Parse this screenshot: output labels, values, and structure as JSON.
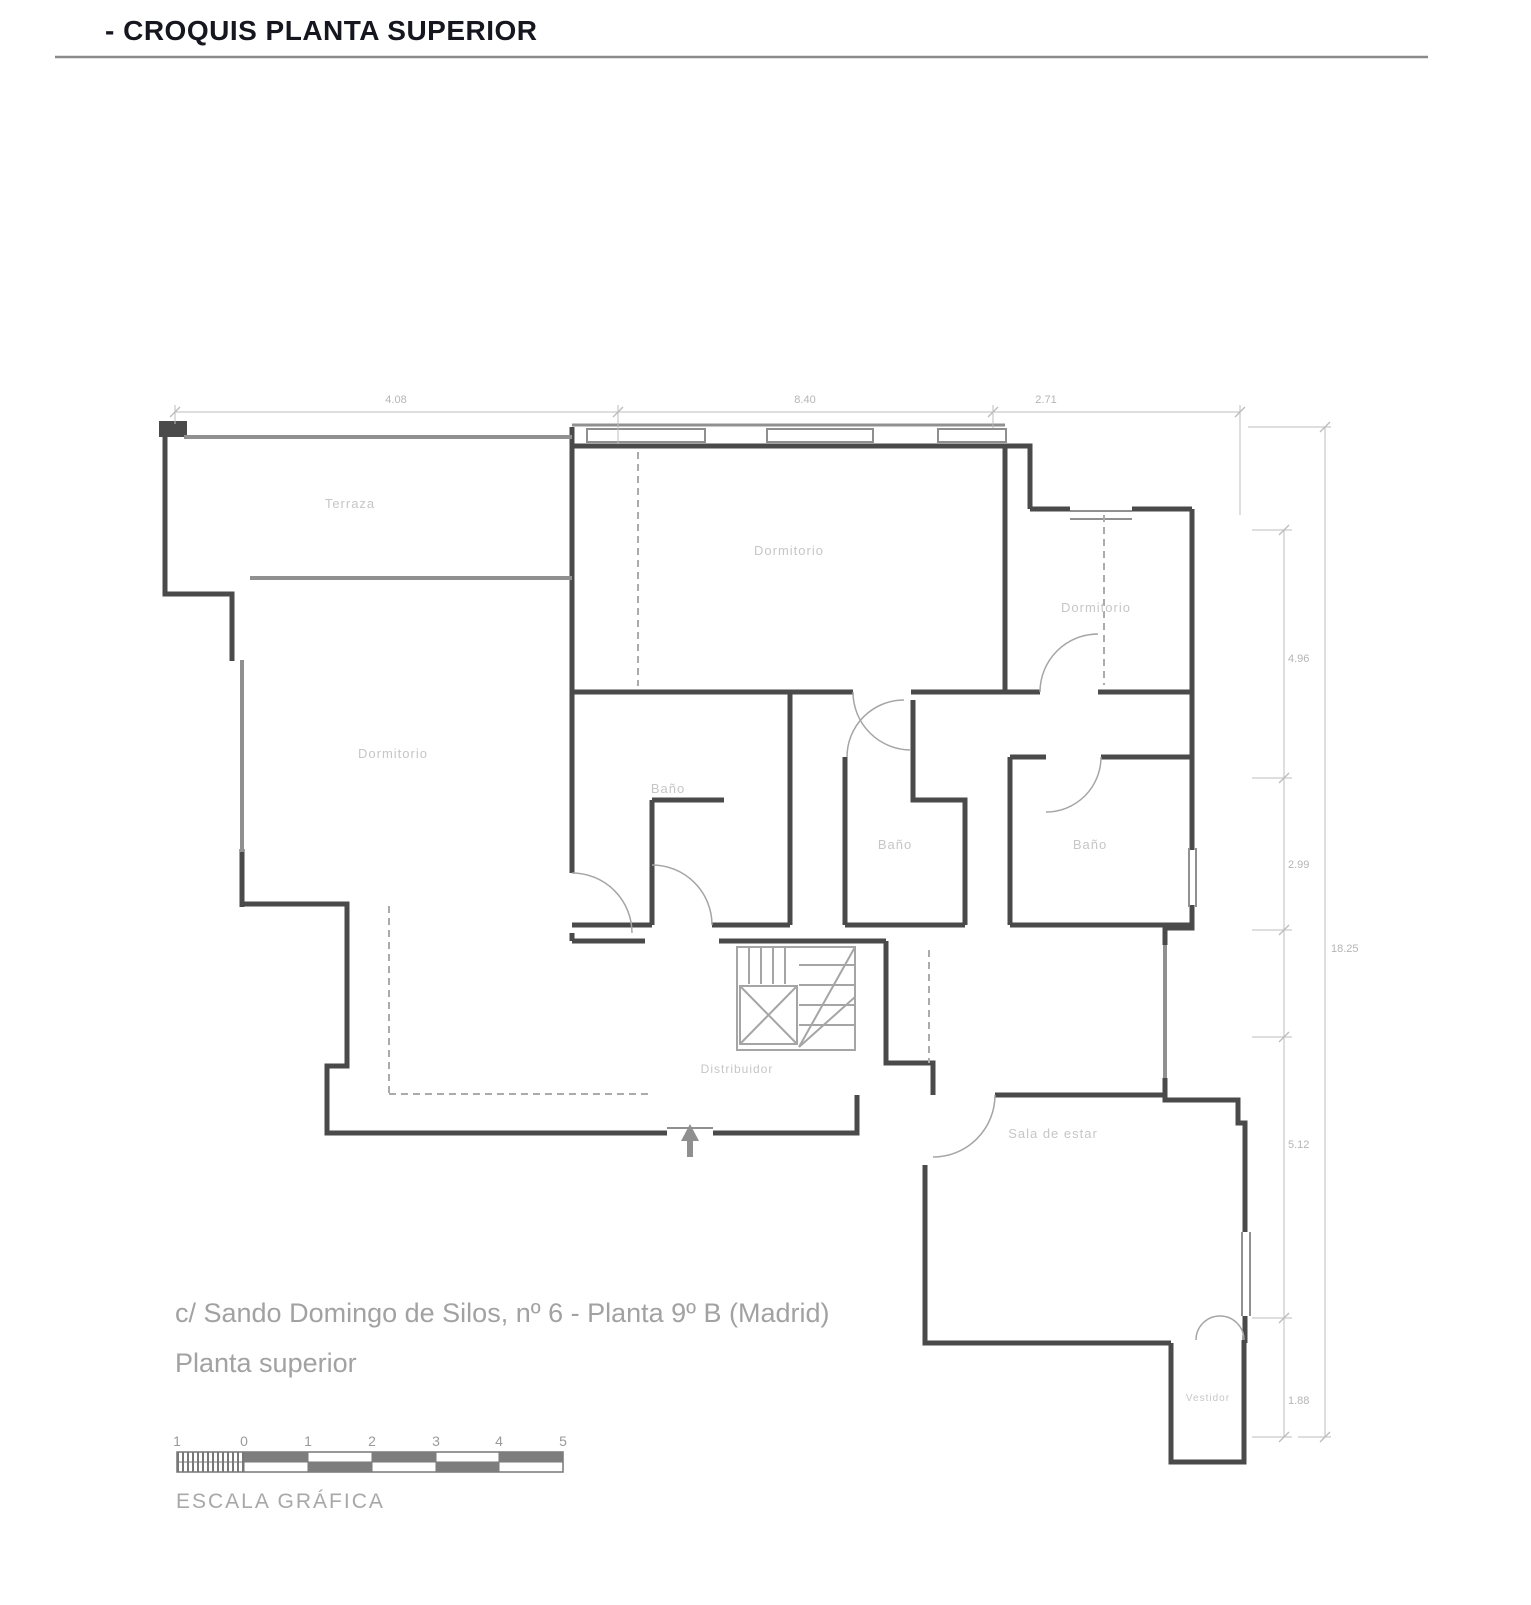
{
  "title": "- CROQUIS PLANTA SUPERIOR",
  "plan": {
    "rooms": {
      "terraza": "Terraza",
      "dormitorio_top": "Dormitorio",
      "dormitorio_right": "Dormitorio",
      "dormitorio_left": "Dormitorio",
      "bano_left": "Baño",
      "bano_center": "Baño",
      "bano_right": "Baño",
      "distribuidor": "Distribuidor",
      "sala": "Sala de estar",
      "vestidor": "Vestidor"
    },
    "dimensions": {
      "top": [
        "4.08",
        "8.40",
        "2.71"
      ],
      "right_inner": [
        "4.96",
        "2.99",
        "5.12",
        "1.88"
      ],
      "right_total": "18.25"
    }
  },
  "footer": {
    "address": "c/ Sando Domingo de Silos, nº 6 - Planta 9º B (Madrid)",
    "floor": "Planta superior",
    "scale_label": "ESCALA GRÁFICA",
    "scale_ticks": [
      "1",
      "0",
      "1",
      "2",
      "3",
      "4",
      "5"
    ]
  },
  "colors": {
    "wall_dark": "#4a4a4a",
    "wall_grey": "#909090",
    "label_grey": "#c6c6c6",
    "dim_grey": "#b5b5b5",
    "text_grey": "#a2a2a2",
    "title_dark": "#16161e"
  }
}
